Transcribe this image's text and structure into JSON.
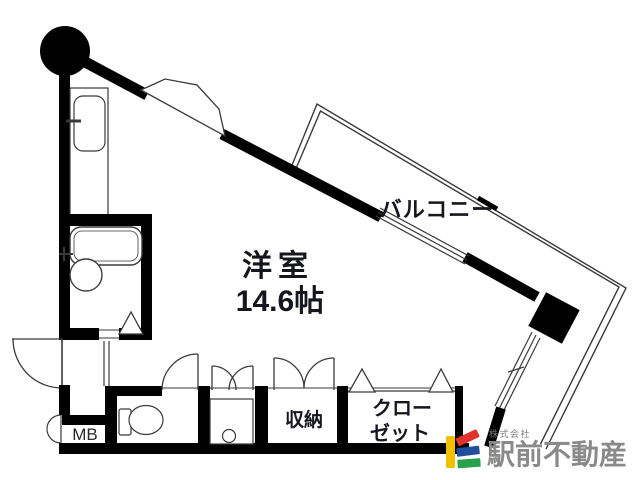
{
  "floorplan": {
    "room": {
      "label": "洋室",
      "size": "14.6帖"
    },
    "balcony": {
      "label": "バルコニー"
    },
    "storage": {
      "label": "収納"
    },
    "closet": {
      "label_line1": "クロー",
      "label_line2": "ゼット"
    },
    "meter_box": {
      "label": "MB"
    }
  },
  "branding": {
    "company_prefix": "株式会社",
    "company_name": "駅前不動産",
    "colors": {
      "yellow": "#f3c000",
      "red": "#e0312a",
      "blue": "#1f4e9c",
      "green": "#27a14a",
      "name_gray": "#8a8a8a",
      "prefix_gray": "#7c7c7c"
    }
  },
  "palette": {
    "wall": "#000000",
    "label_ink": "#16161f",
    "thin_line": "#3a3a3a"
  }
}
